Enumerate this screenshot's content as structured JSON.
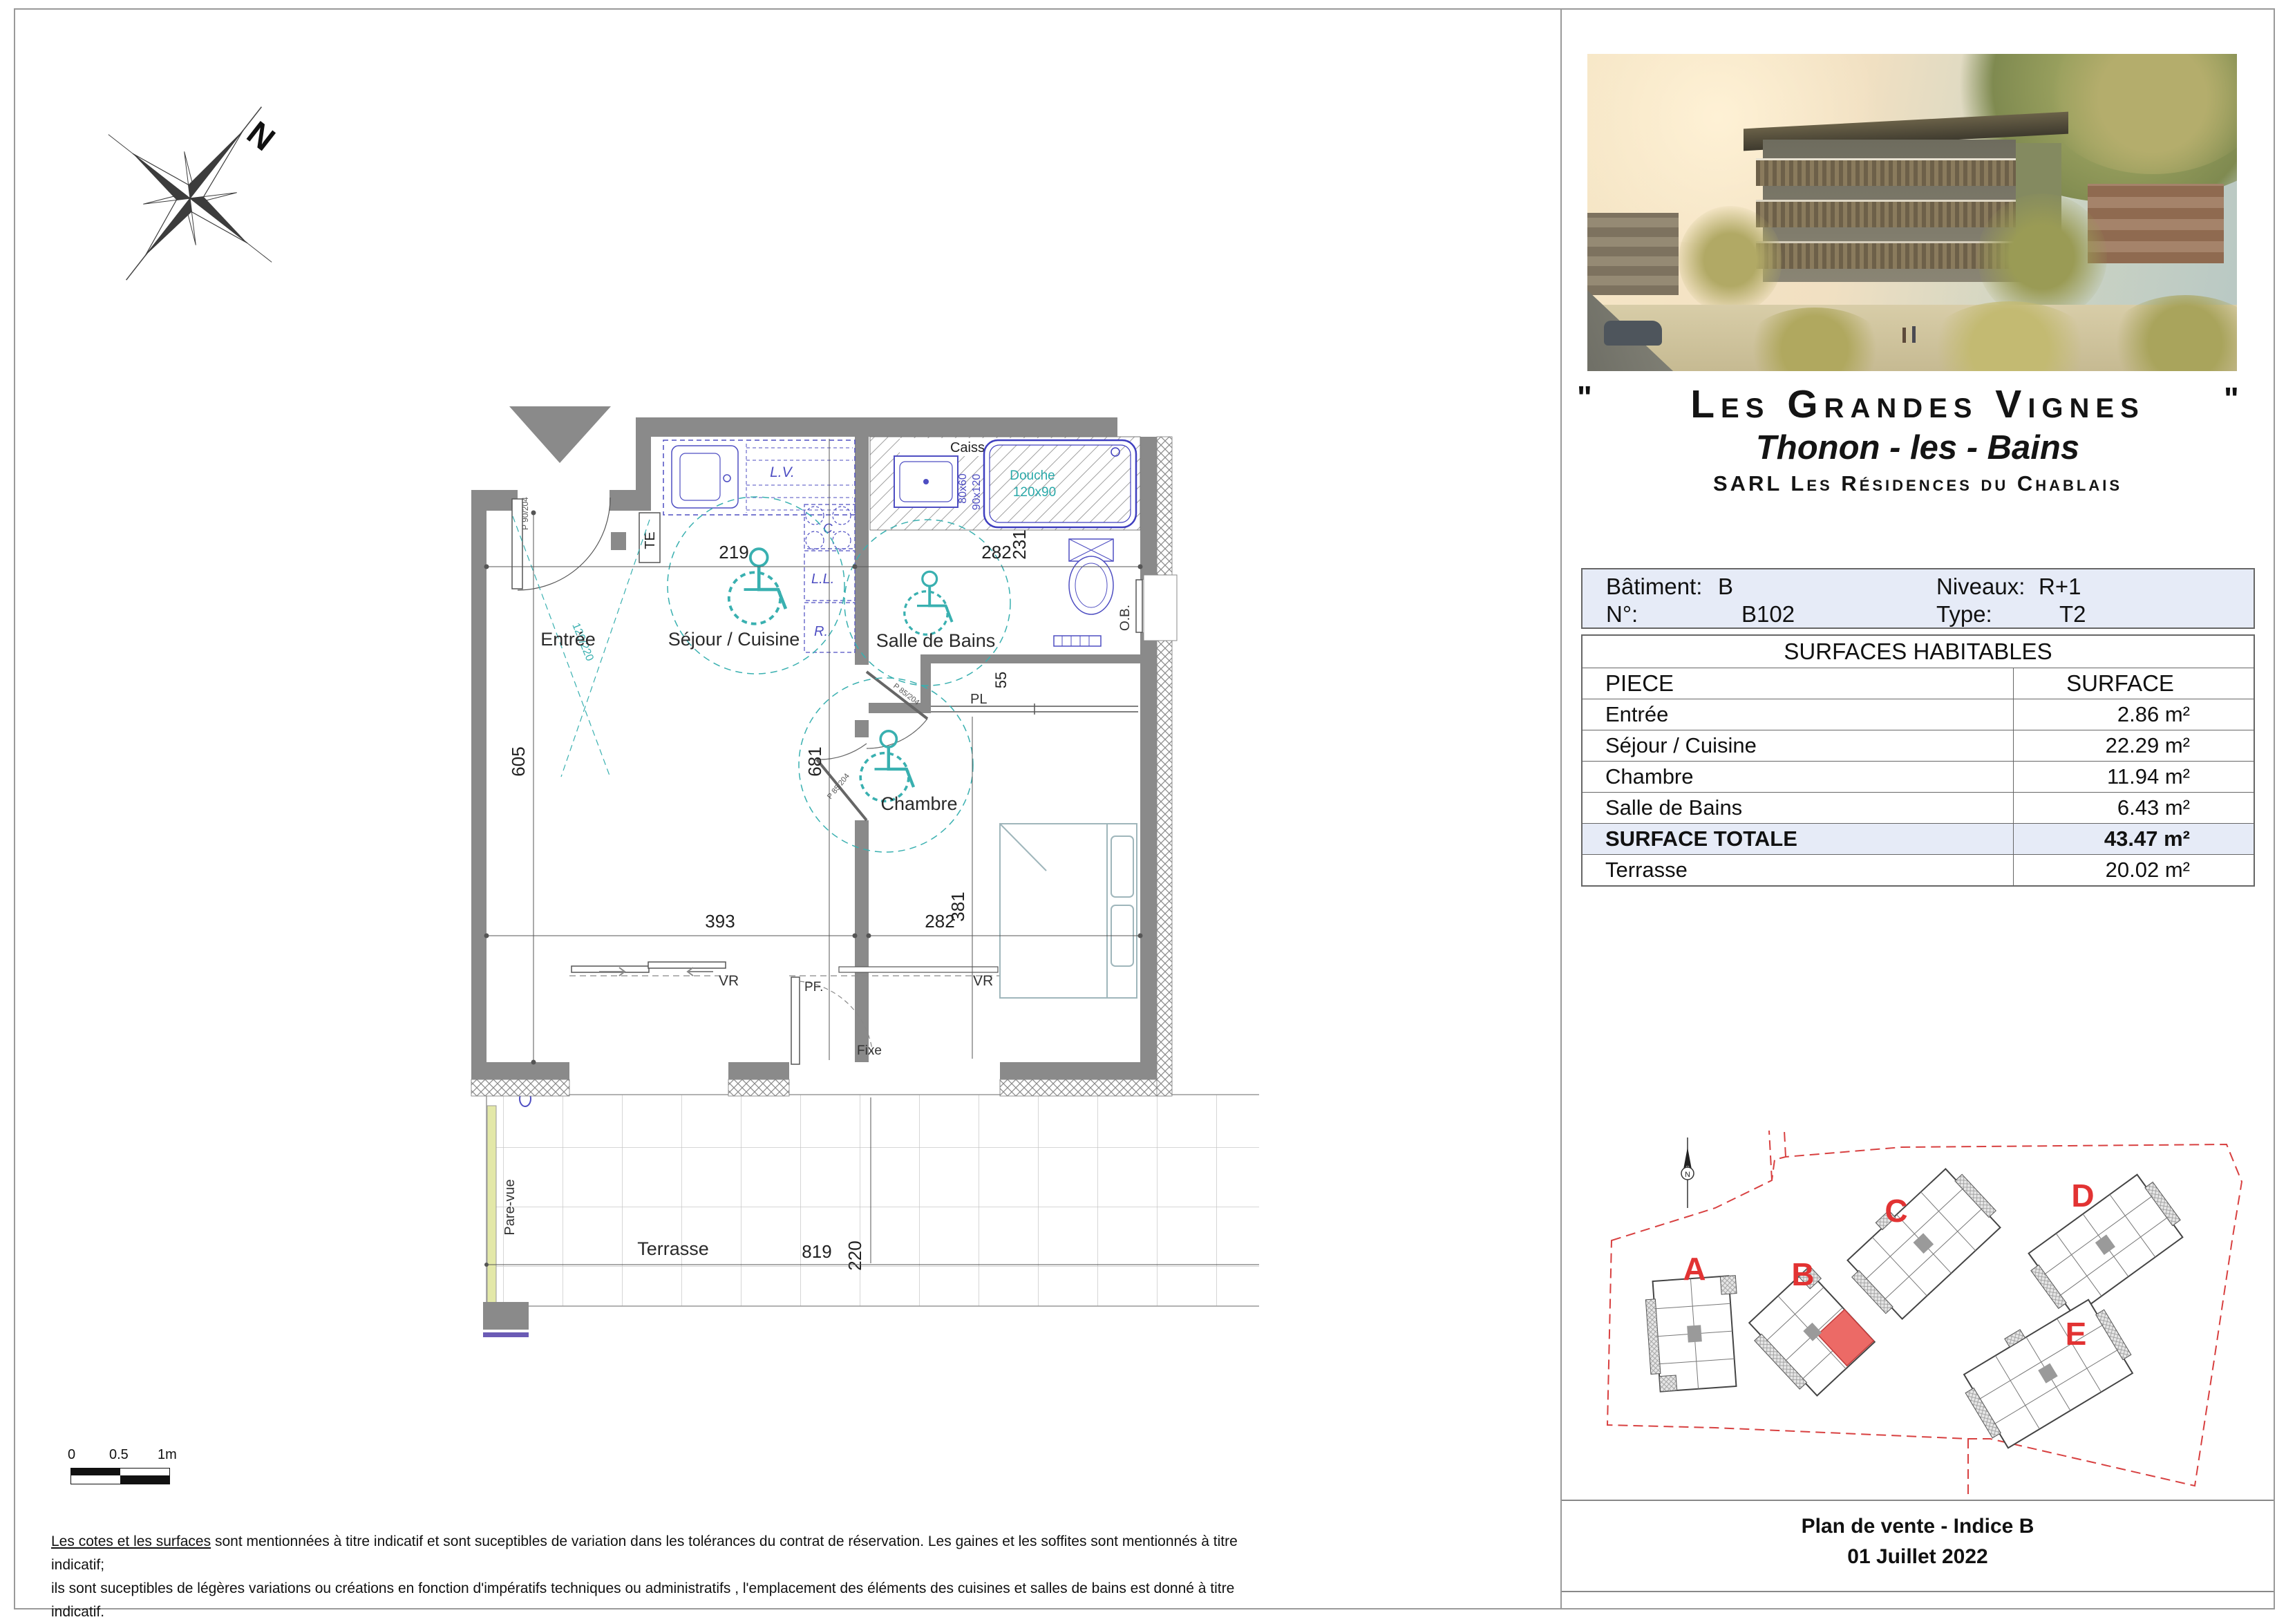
{
  "colors": {
    "wall_gray": "#8a8a8a",
    "fixture_blue": "#4e4ec2",
    "accessibility_teal": "#39b0b0",
    "site_red": "#e23333",
    "table_blue": "#e6ebf7"
  },
  "compass": {
    "north": "N"
  },
  "floor_plan": {
    "rooms": {
      "entree": "Entrée",
      "sejour": "Séjour / Cuisine",
      "salle_de_bains": "Salle de Bains",
      "chambre": "Chambre",
      "terrasse": "Terrasse"
    },
    "dims": {
      "d219": "219",
      "d282_top": "282",
      "d231": "231",
      "d605": "605",
      "d681": "681",
      "d55": "55",
      "d393": "393",
      "d282_bottom": "282",
      "d381": "381",
      "d220": "220",
      "d819": "819"
    },
    "labels": {
      "te": "TE",
      "pl": "PL",
      "vr": "VR",
      "pf": "PF.",
      "fixe": "Fixe",
      "ob": "O.B.",
      "pare_vue": "Pare-vue",
      "lv": "L.V.",
      "c": "C.",
      "ll": "L.L.",
      "r": "R.",
      "caisson_bas": "Caisson bas",
      "douche_l1": "Douche",
      "douche_l2": "120x90",
      "s80x60": "80x60",
      "s90x120": "90x120",
      "door_entry": "P 90/204",
      "door_int": "P 85/204",
      "turn": "120/220"
    }
  },
  "scale_bar": {
    "t0": "0",
    "t05": "0.5",
    "t1": "1m"
  },
  "disclaimer": {
    "lead": "Les cotes et les surfaces",
    "line1": " sont mentionnées à titre indicatif et sont suceptibles de variation dans les tolérances du contrat de réservation. Les gaines et les soffites sont mentionnés à titre indicatif;",
    "line2": "ils sont suceptibles de légères variations ou créations en fonction d'impératifs techniques ou administratifs , l'emplacement des éléments des cuisines et salles de bains est donné à titre indicatif."
  },
  "panel": {
    "quote": "\"",
    "title": "Les Grandes Vignes",
    "subtitle": "Thonon - les - Bains",
    "company": "SARL Les Résidences du Chablais",
    "info": {
      "batiment_label": "Bâtiment:",
      "batiment_value": "B",
      "niveaux_label": "Niveaux:",
      "niveaux_value": "R+1",
      "numero_label": "N°:",
      "numero_value": "B102",
      "type_label": "Type:",
      "type_value": "T2"
    },
    "surfaces": {
      "title": "SURFACES HABITABLES",
      "col_piece": "PIECE",
      "col_surface": "SURFACE",
      "rows": [
        {
          "piece": "Entrée",
          "surface": "2.86 m²"
        },
        {
          "piece": "Séjour / Cuisine",
          "surface": "22.29 m²"
        },
        {
          "piece": "Chambre",
          "surface": "11.94 m²"
        },
        {
          "piece": "Salle de Bains",
          "surface": "6.43 m²"
        }
      ],
      "total_label": "SURFACE TOTALE",
      "total_value": "43.47 m²",
      "terrasse_label": "Terrasse",
      "terrasse_value": "20.02 m²"
    },
    "site_plan": {
      "buildings": [
        "A",
        "B",
        "C",
        "D",
        "E"
      ],
      "north": "N"
    },
    "footer": {
      "line1": "Plan de vente - Indice B",
      "line2": "01 Juillet 2022"
    }
  }
}
